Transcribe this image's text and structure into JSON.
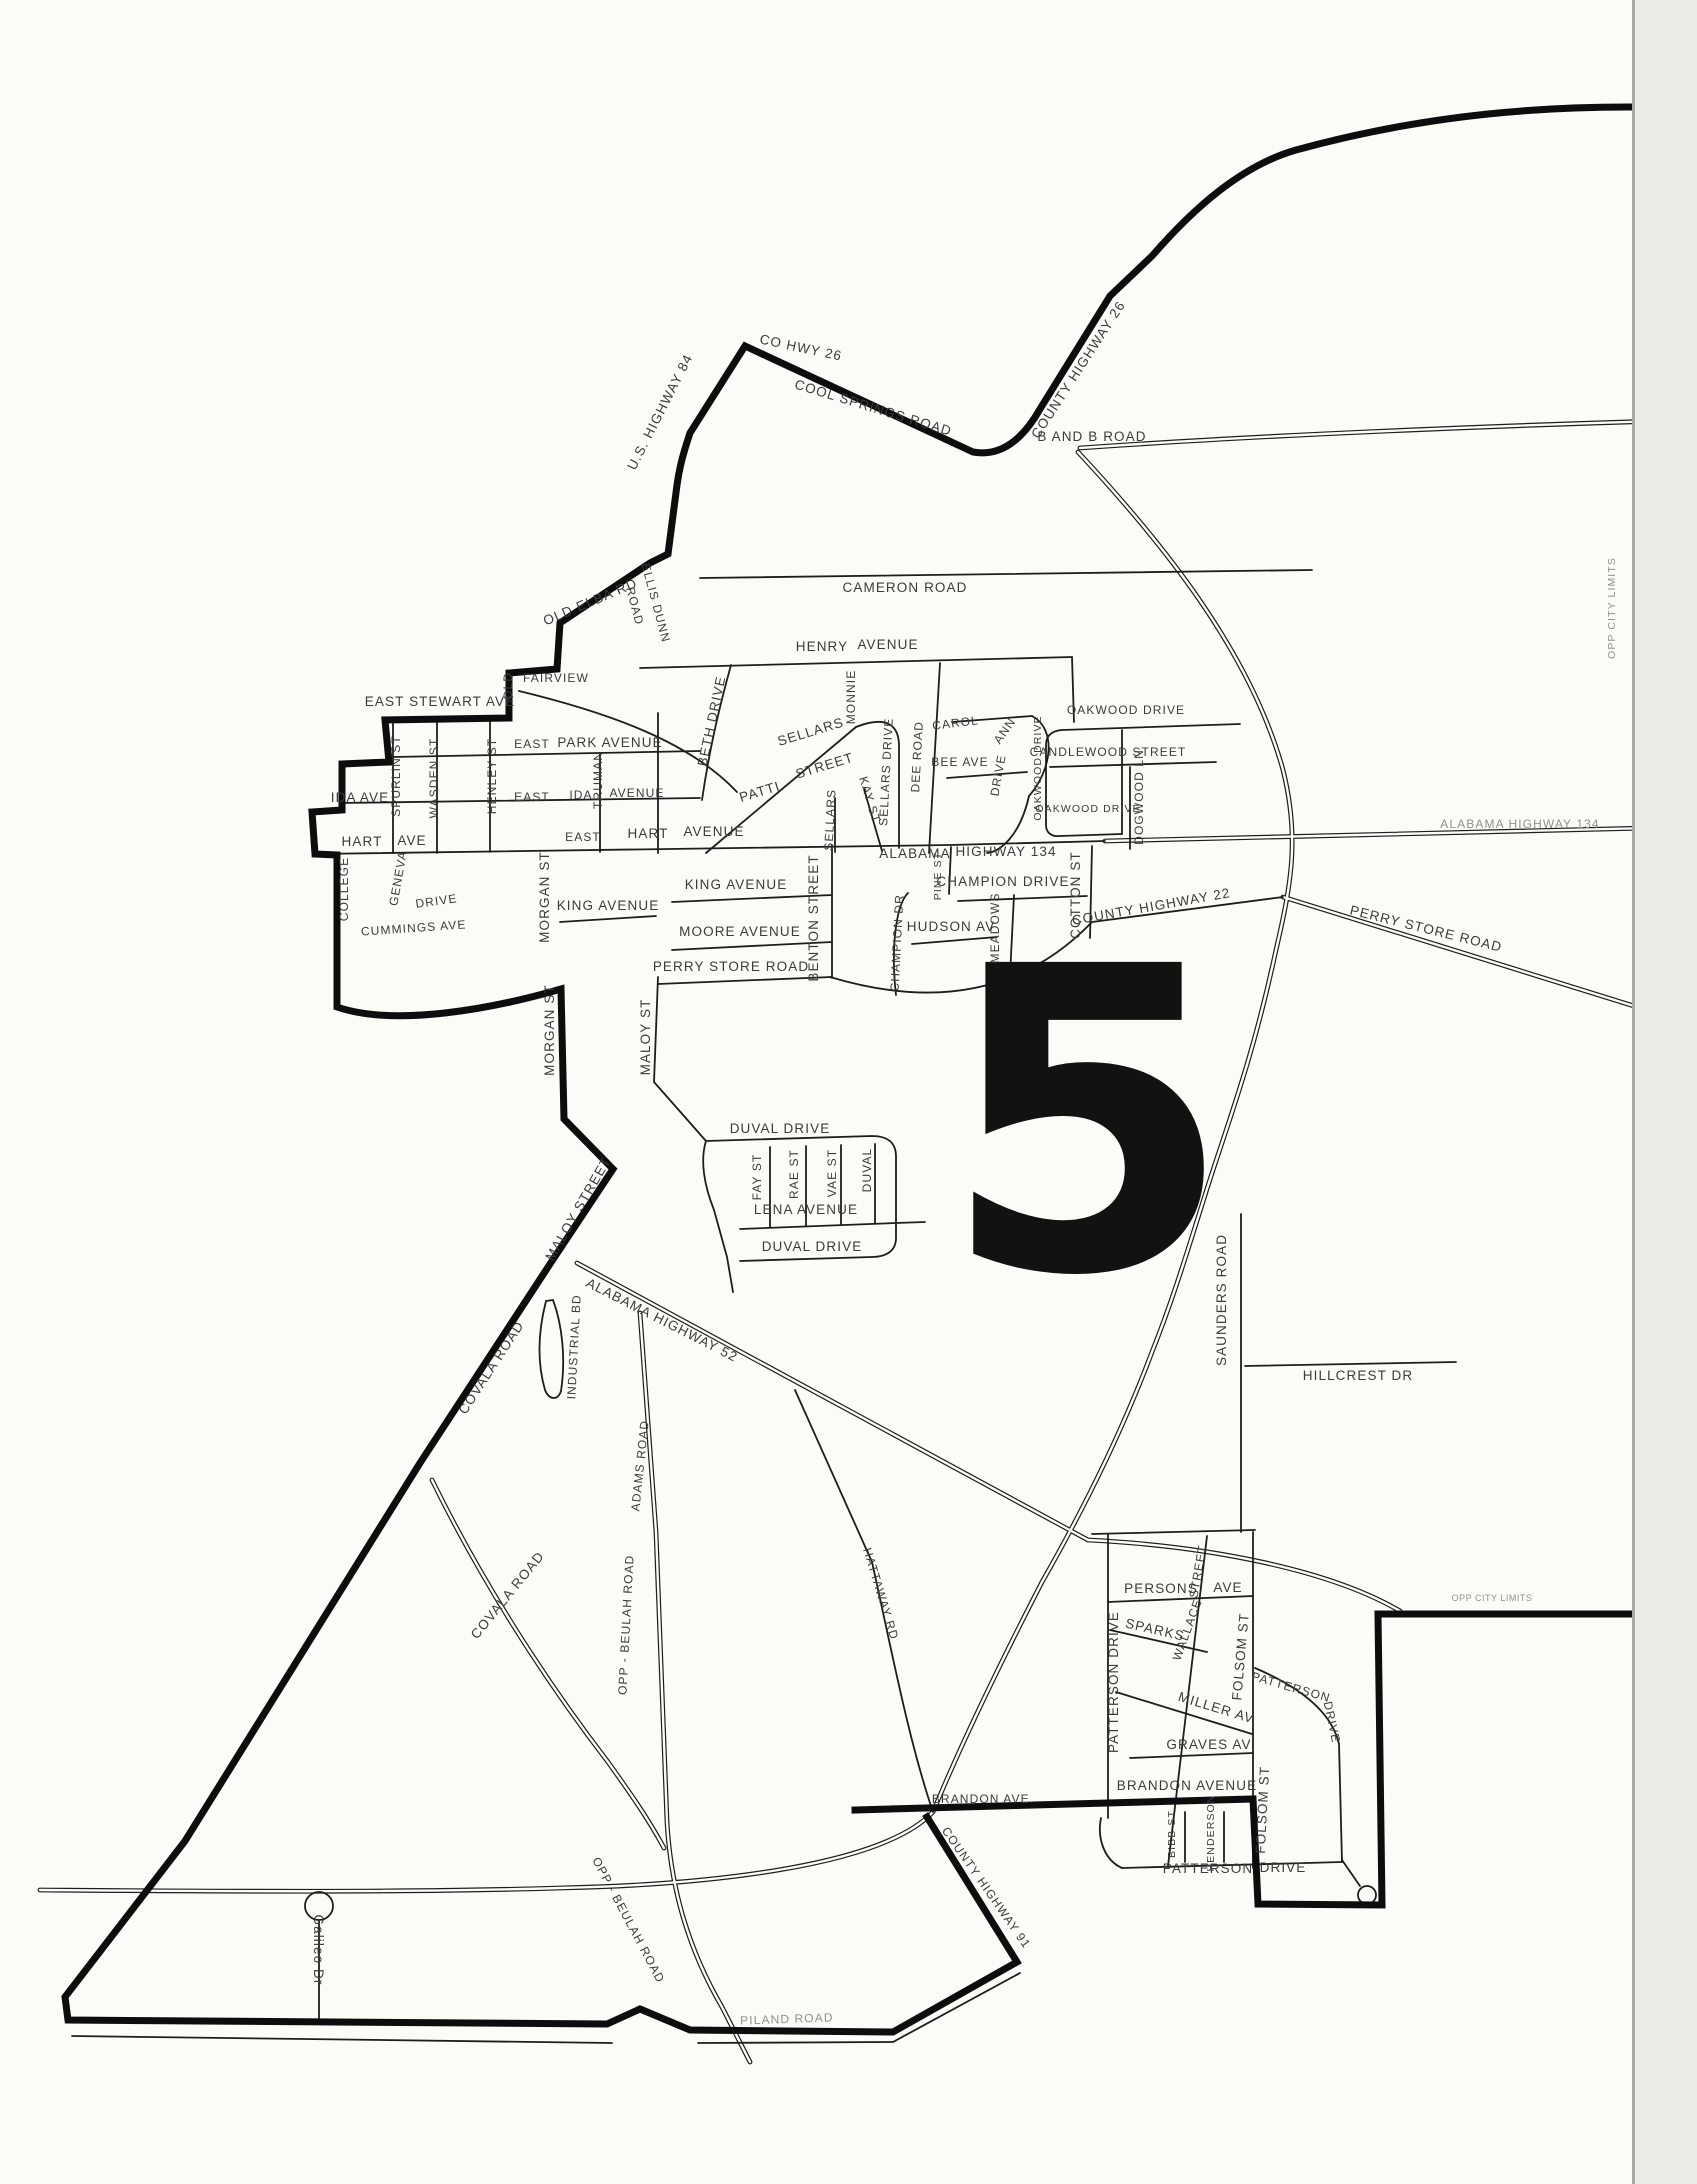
{
  "district": {
    "number": "5"
  },
  "city_limits": {
    "top_right": "OPP CITY LIMITS",
    "mid_right": "OPP CITY LIMITS"
  },
  "labels": {
    "district_number": "5",
    "co_hwy_26": "CO HWY 26",
    "cool_springs_road": "COOL SPRINGS ROAD",
    "county_highway_26": "COUNTY HIGHWAY 26",
    "b_and_b_road": "B AND B ROAD",
    "us_highway_84": "U.S. HIGHWAY 84",
    "old_elba_rd": "OLD ELBA RD",
    "ellis_dunn": "ELLIS DUNN",
    "ellis_dunn_road": "ROAD",
    "cameron_road": "CAMERON ROAD",
    "henry": "HENRY",
    "henry_avenue": "AVENUE",
    "old_word": "OLD",
    "fairview": "FAIRVIEW",
    "east_stewart_ave": "EAST STEWART AVE",
    "spurlin_st": "SPURLIN ST",
    "wasden_st": "WASDEN ST",
    "henley_st": "HENLEY ST",
    "east_park": "EAST",
    "park_avenue": "PARK AVENUE",
    "truman": "TRUMAN",
    "east_ida": "EAST",
    "ida_word": "IDA",
    "ida_avenue_word": "AVENUE",
    "ida_ave": "IDA AVE",
    "hart_w": "HART",
    "ave_w": "AVE",
    "east_hart": "EAST",
    "hart_word": "HART",
    "hart_avenue_word": "AVENUE",
    "college": "COLLEGE",
    "geneva": "GENEVA",
    "geneva_drive": "DRIVE",
    "cummings_ave": "CUMMINGS AVE",
    "morgan_st_upper": "MORGAN ST",
    "morgan_st_lower": "MORGAN ST",
    "king_avenue_w": "KING AVENUE",
    "king_avenue_e": "KING AVENUE",
    "moore_avenue": "MOORE AVENUE",
    "perry_store_road_w": "PERRY STORE ROAD",
    "perry_store_road_e": "PERRY STORE ROAD",
    "benton_street": "BENTON STREET",
    "alabama_word": "ALABAMA",
    "highway_134": "HIGHWAY 134",
    "alabama_highway_134_e": "ALABAMA HIGHWAY 134",
    "pine_st": "PINE ST",
    "champion_drive": "CHAMPION DRIVE",
    "champion_dr": "CHAMPION DR",
    "hudson_av": "HUDSON AV",
    "meadows": "MEADOWS",
    "cotton_st": "COTTON ST",
    "county_highway_22": "COUNTY HIGHWAY 22",
    "beth_drive": "BETH DRIVE",
    "monnie": "MONNIE",
    "sellars_diag": "SELLARS",
    "street_diag": "STREET",
    "patti": "PATTI",
    "kay_st": "KAY ST",
    "sellars_v": "SELLARS",
    "sellars_drive": "SELLARS DRIVE",
    "dee_road": "DEE ROAD",
    "carol": "CAROL",
    "ann": "ANN",
    "ann_drive": "DRIVE",
    "bee_ave": "BEE AVE",
    "oakwood_drive_top": "OAKWOOD DRIVE",
    "oakwood_drive_left": "OAKWOOD DRIVE",
    "oakwood_drive_bottom": "OAKWOOD DRIVE",
    "candlewood_street": "CANDLEWOOD STREET",
    "dogwood_ln": "DOGWOOD LN",
    "duval_drive_top": "DUVAL DRIVE",
    "fay_st": "FAY ST",
    "rae_st": "RAE ST",
    "vae_st": "VAE ST",
    "duval_v": "DUVAL",
    "lena_avenue": "LENA AVENUE",
    "duval_drive_bottom": "DUVAL DRIVE",
    "maloy_st": "MALOY ST",
    "maloy_street": "MALOY STREET",
    "covala_road_upper": "COVALA ROAD",
    "covala_road_lower": "COVALA ROAD",
    "industrial_bd": "INDUSTRIAL BD",
    "alabama_highway_52": "ALABAMA HIGHWAY 52",
    "adams_road": "ADAMS ROAD",
    "opp_beulah_road_v": "OPP - BEULAH ROAD",
    "opp_beulah_road_d": "OPP - BEULAH ROAD",
    "hattaway_rd": "HATTAWAY RD",
    "county_highway_91": "COUNTY HIGHWAY 91",
    "saunders_road": "SAUNDERS ROAD",
    "hillcrest_dr": "HILLCREST DR",
    "persons": "PERSONS",
    "persons_ave": "AVE",
    "wallace": "WALLACE",
    "wallace_street_word": "STREET",
    "sparks": "SPARKS",
    "folsom_st_upper": "FOLSOM ST",
    "folsom_st_lower": "FOLSOM ST",
    "patterson_drive_left": "PATTERSON DRIVE",
    "patterson_diag": "PATTERSON",
    "patterson_diag_drive": "DRIVE",
    "miller_av": "MILLER AV",
    "graves_av": "GRAVES AV",
    "brandon_avenue": "BRANDON AVENUE",
    "brandon_ave_w": "BRANDON AVE.",
    "bibb_st": "BIBB ST",
    "henderson": "HENDERSON",
    "patterson_bottom": "PATTERSON",
    "patterson_bottom_drive": "DRIVE",
    "galileo_dr": "Galileo Dr",
    "piland_road": "PILAND ROAD",
    "opp_city_limits_top": "OPP CITY LIMITS",
    "opp_city_limits_mid": "OPP CITY LIMITS"
  }
}
